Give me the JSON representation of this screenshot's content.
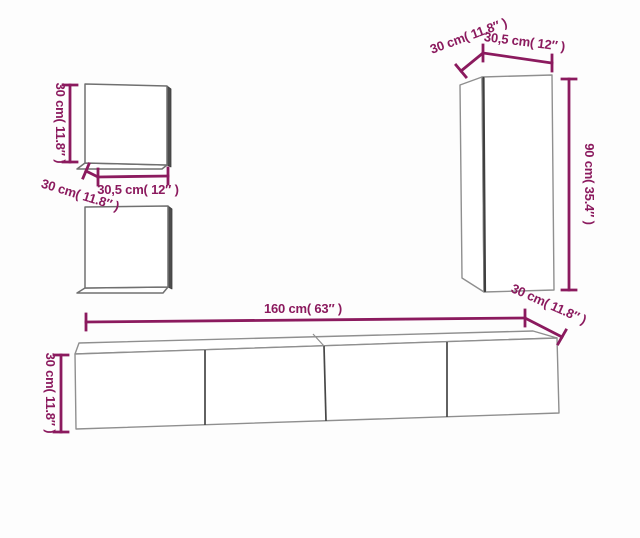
{
  "diagram": {
    "colors": {
      "dimension_accent": "#8B1A5E",
      "cabinet_outline": "#8F8F8F",
      "cabinet_edge_dark": "#3F3F3F",
      "cabinet_fill": "#FFFFFF",
      "background": "#FDFDFD"
    },
    "components": {
      "wall_cabinet_top": {
        "height_label": "30 cm( 11.8″ )",
        "width_label": "30,5 cm( 12″ )",
        "depth_label": "30 cm( 11.8″ )"
      },
      "tall_cabinet": {
        "depth_label": "30 cm( 11.8″ )",
        "width_label": "30,5 cm( 12″ )",
        "height_label": "90 cm( 35.4″ )"
      },
      "tv_bench": {
        "width_label": "160 cm( 63″ )",
        "height_label": "30 cm( 11.8″ )",
        "depth_label": "30 cm( 11.8″ )"
      }
    }
  }
}
